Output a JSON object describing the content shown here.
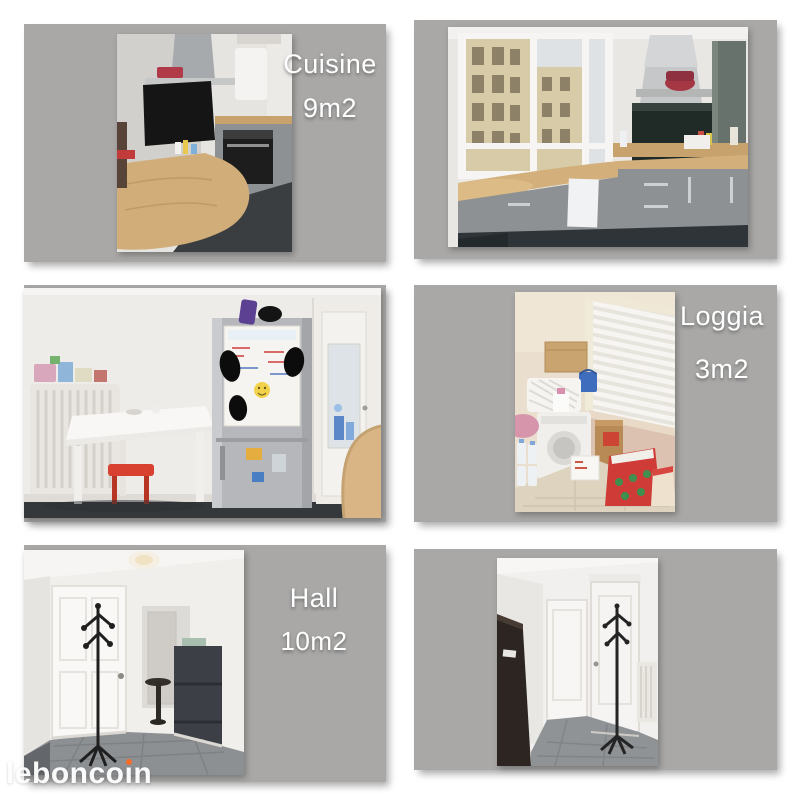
{
  "collage": {
    "cells": [
      {
        "name": "cuisine-photo-left",
        "room": "Cuisine",
        "area": "9m2"
      },
      {
        "name": "cuisine-photo-right"
      },
      {
        "name": "kitchen-dining-photo"
      },
      {
        "name": "loggia-photo",
        "room": "Loggia",
        "area": "3m2"
      },
      {
        "name": "hall-photo-left",
        "room": "Hall",
        "area": "10m2"
      },
      {
        "name": "hall-photo-right"
      }
    ]
  },
  "watermark": {
    "text": "leboncoin",
    "prefix": "lebonco",
    "i_glyph": "ı",
    "suffix": "n",
    "dot_color": "#f56b2a"
  },
  "colors": {
    "page_background": "#ffffff",
    "cell_background": "#a9a8a7",
    "label_text": "#ffffff"
  }
}
